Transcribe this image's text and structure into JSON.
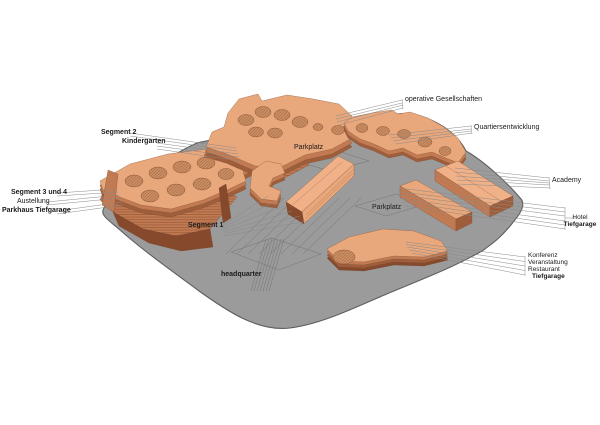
{
  "labels": {
    "segment2": "Segment 2",
    "kindergarten": "Kindergarten",
    "segment34": "Segment 3 und 4",
    "austellung": "Austellung",
    "parkhaus_tiefgarage": "Parkhaus Tiefgarage",
    "segment1": "Segment 1",
    "headquarter": "headquarter",
    "parkplatz_north": "Parkplatz",
    "parkplatz_east": "Parkplatz",
    "operative": "operative Gesellschaften",
    "quartiersentwicklung": "Quartiersentwicklung",
    "academy": "Academy",
    "hotel": "Hotel",
    "hotel_sub": "Tiefgarage",
    "konferenz": "Konferenz",
    "veranstaltung": "Veranstaltung",
    "restaurant": "Restaurant",
    "konferenz_sub": "Tiefgarage"
  },
  "colors": {
    "building_top": "#E9A77C",
    "building_top_light": "#F0B189",
    "building_side": "#C17A52",
    "building_dark": "#9E5E3C",
    "building_deep": "#86492C",
    "courtyard": "#C98B60",
    "ground": "#9B9B9B",
    "ground_edge": "#5E5E5E",
    "ground_line": "#747474",
    "leader": "#8A8A8A",
    "label": "#1A1A1A"
  }
}
